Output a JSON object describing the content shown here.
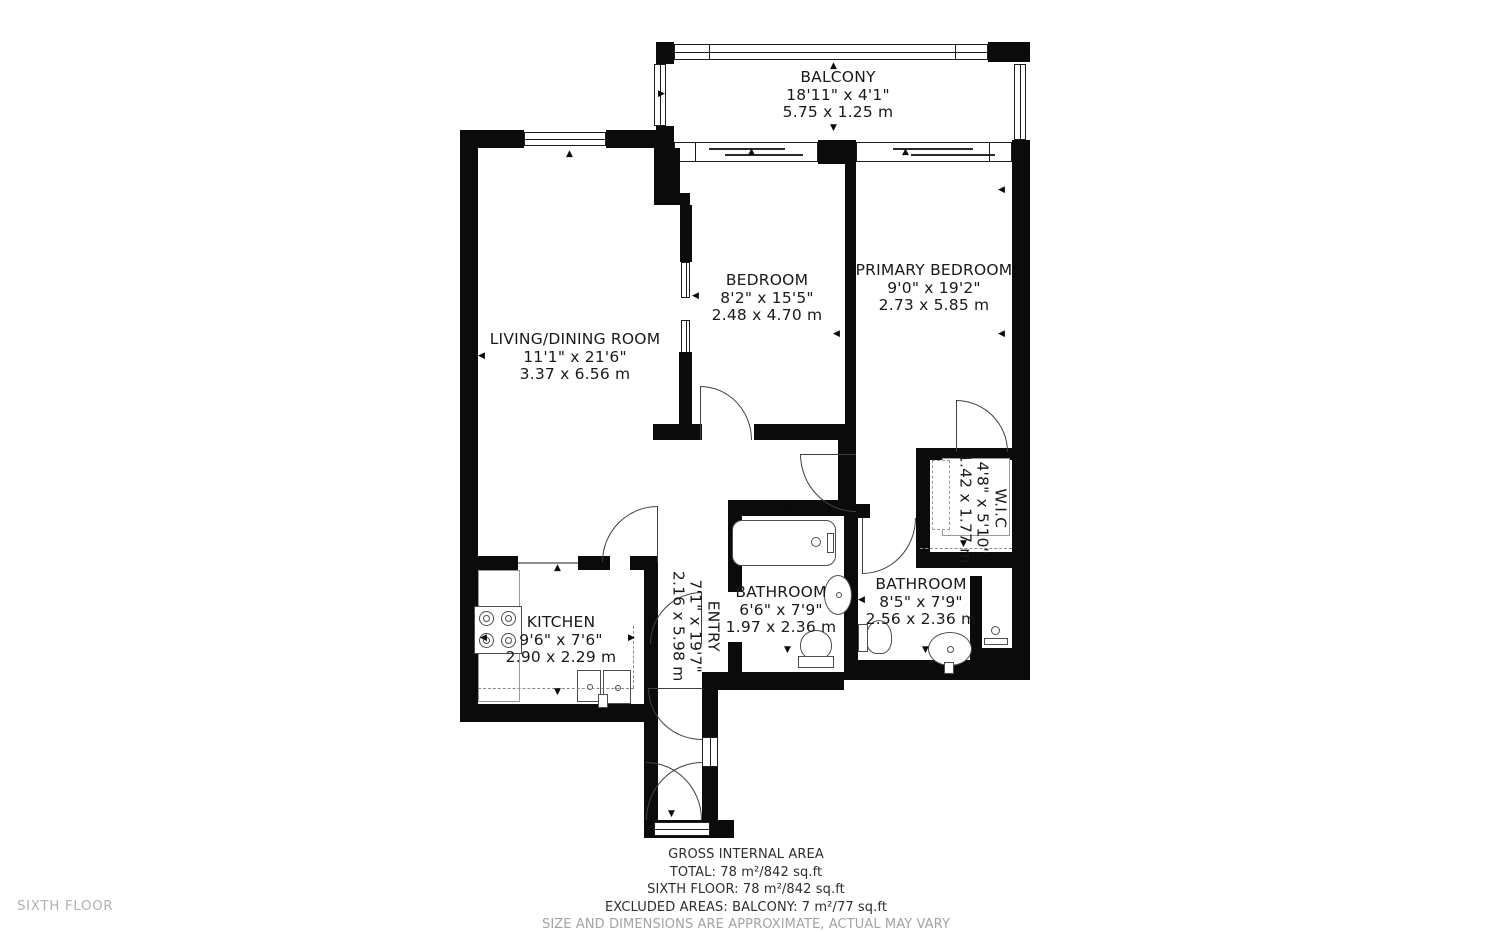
{
  "meta": {
    "floor_label": "SIXTH FLOOR"
  },
  "rooms": {
    "balcony": {
      "name": "BALCONY",
      "imperial": "18'11\" x 4'1\"",
      "metric": "5.75 x 1.25 m"
    },
    "living": {
      "name": "LIVING/DINING ROOM",
      "imperial": "11'1\" x 21'6\"",
      "metric": "3.37 x 6.56 m"
    },
    "bedroom": {
      "name": "BEDROOM",
      "imperial": "8'2\" x 15'5\"",
      "metric": "2.48 x 4.70 m"
    },
    "primary_bedroom": {
      "name": "PRIMARY BEDROOM",
      "imperial": "9'0\" x 19'2\"",
      "metric": "2.73 x 5.85 m"
    },
    "wic": {
      "name": "W.I.C",
      "imperial": "4'8\" x 5'10\"",
      "metric": "1.42 x 1.77 m"
    },
    "bathroom1": {
      "name": "BATHROOM",
      "imperial": "6'6\" x 7'9\"",
      "metric": "1.97 x 2.36 m"
    },
    "bathroom2": {
      "name": "BATHROOM",
      "imperial": "8'5\" x 7'9\"",
      "metric": "2.56 x 2.36 m"
    },
    "kitchen": {
      "name": "KITCHEN",
      "imperial": "9'6\" x 7'6\"",
      "metric": "2.90 x 2.29 m"
    },
    "entry": {
      "name": "ENTRY",
      "imperial": "7'1\" x 19'7\"",
      "metric": "2.16 x 5.98 m"
    }
  },
  "footer": {
    "line1": "GROSS INTERNAL AREA",
    "line2": "TOTAL: 78 m²/842 sq.ft",
    "line3": "SIXTH FLOOR: 78 m²/842 sq.ft",
    "line4": "EXCLUDED AREAS: BALCONY: 7 m²/77 sq.ft",
    "disclaimer": "SIZE AND DIMENSIONS ARE APPROXIMATE, ACTUAL MAY VARY"
  }
}
